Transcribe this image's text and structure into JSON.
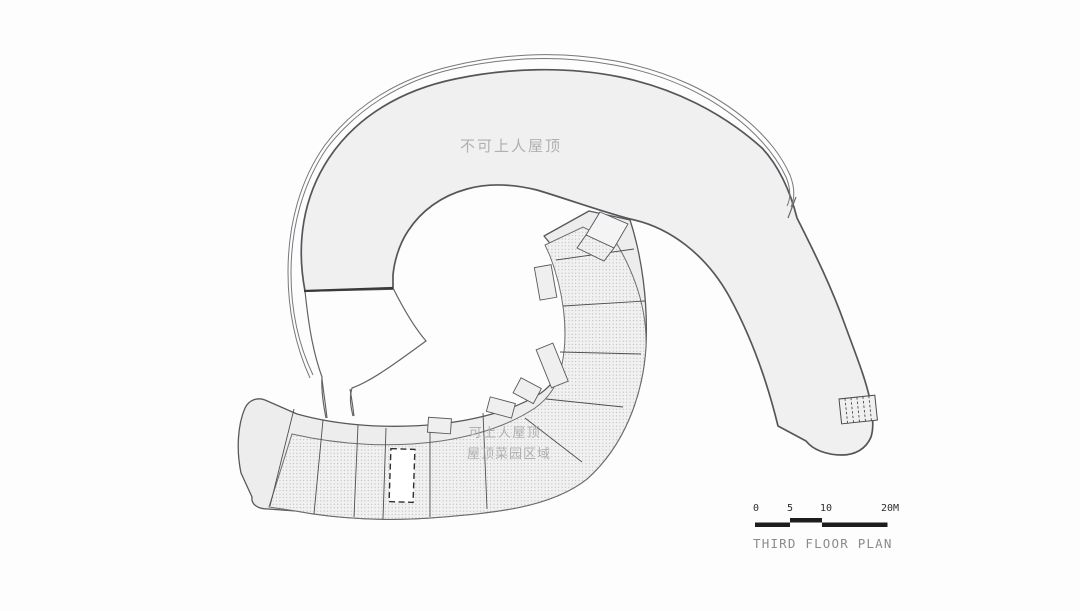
{
  "drawing": {
    "labels": {
      "non_accessible_roof": "不可上人屋顶",
      "accessible_roof": "可上人屋顶",
      "roof_garden_area": "屋顶菜园区域"
    },
    "scale_bar": {
      "ticks": [
        "0",
        "5",
        "10",
        "20M"
      ]
    },
    "title": "THIRD FLOOR PLAN",
    "colors": {
      "roof_fill": "#f0f0f1",
      "walkway_fill": "#ededee",
      "outline": "#55565a",
      "hatch_dot": "#a9a9ab",
      "hatch_bg": "#f1f1f2",
      "label_text": "#b0b0b1",
      "scale_bar": "#1d1d1d",
      "title_text": "#8b8b8b"
    }
  }
}
